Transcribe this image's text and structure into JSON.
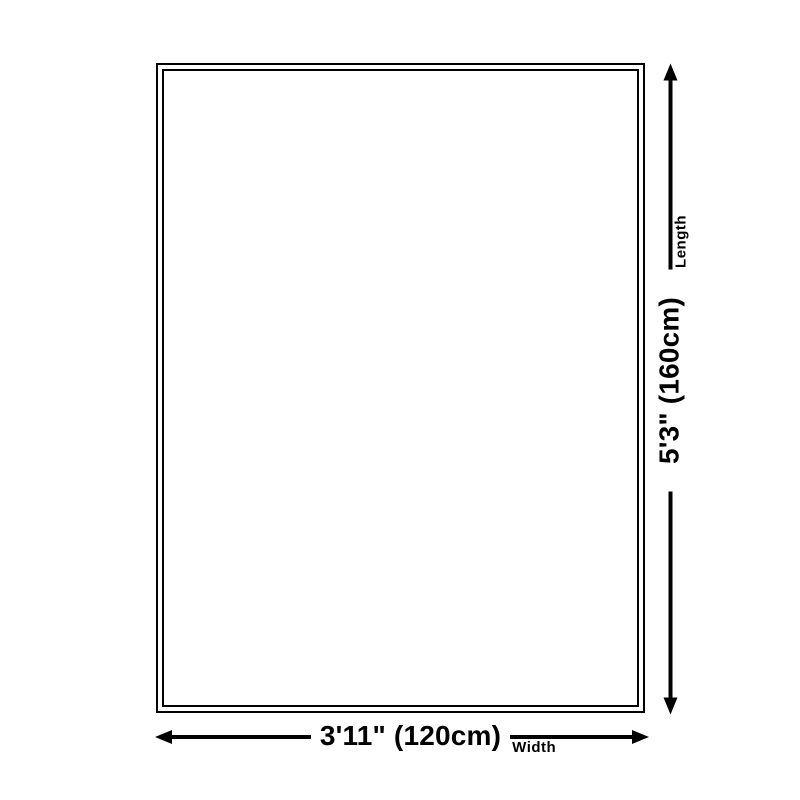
{
  "diagram": {
    "background_color": "#ffffff",
    "line_color": "#000000",
    "rug_outline": "double-border rectangle",
    "length": {
      "value_label": "5'3\" (160cm)",
      "axis_label": "Length"
    },
    "width": {
      "value_label": "3'11\" (120cm)",
      "axis_label": "Width"
    },
    "icons": {
      "vertical_dimension": [
        "arrow-down-icon",
        "arrow-up-icon"
      ],
      "horizontal_dimension": [
        "arrow-left-icon",
        "arrow-right-icon"
      ]
    }
  }
}
